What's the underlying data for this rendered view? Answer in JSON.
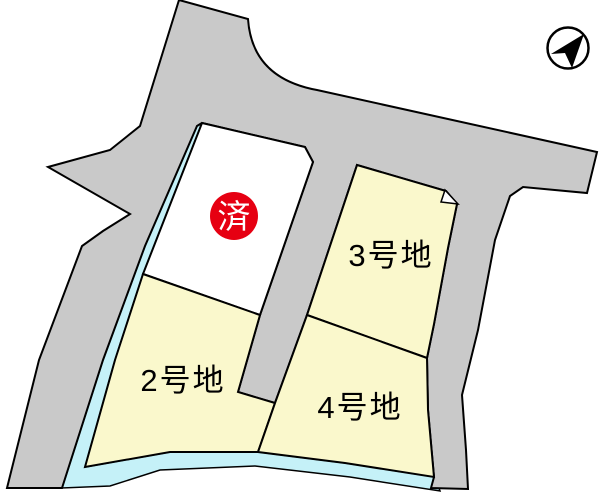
{
  "map": {
    "title": "lot-map",
    "colors": {
      "road": "#C9C9C9",
      "water": "#C5F1F8",
      "lot": "#FAF8CC",
      "sold_lot": "#FFFFFF",
      "sold_badge": "#E60012",
      "sold_badge_text": "#FFFFFF",
      "outline": "#000000",
      "background": "#FFFFFF"
    },
    "lots": [
      {
        "id": "lot-1",
        "label": "",
        "status": "sold",
        "sold_badge": "済"
      },
      {
        "id": "lot-2",
        "label": "2号地",
        "status": "available"
      },
      {
        "id": "lot-3",
        "label": "3号地",
        "status": "available"
      },
      {
        "id": "lot-4",
        "label": "4号地",
        "status": "available"
      }
    ],
    "icons": {
      "compass": "north-arrow"
    }
  }
}
